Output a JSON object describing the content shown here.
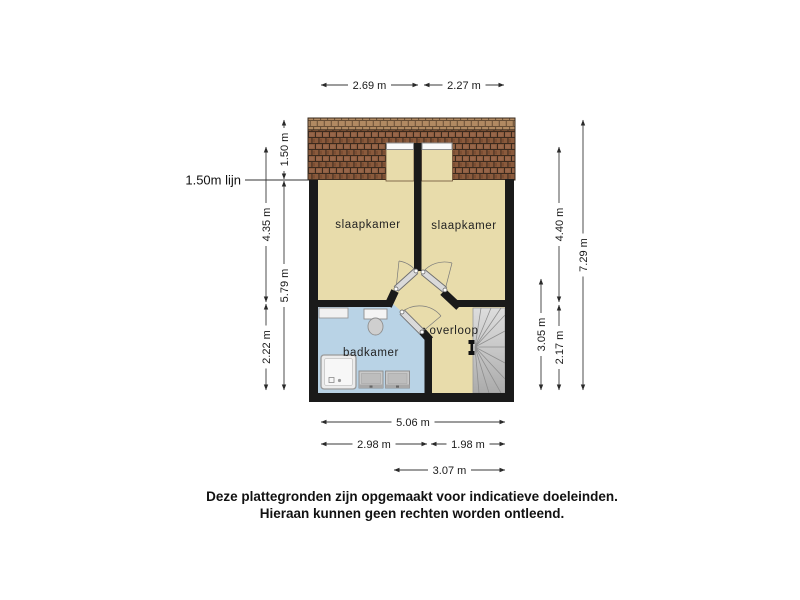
{
  "floorplan": {
    "rooms": {
      "slaapkamer_left": {
        "label": "slaapkamer"
      },
      "slaapkamer_right": {
        "label": "slaapkamer"
      },
      "badkamer": {
        "label": "badkamer"
      },
      "overloop": {
        "label": "overloop"
      }
    },
    "annotations": {
      "height_line_label": "1.50m lijn"
    },
    "dimensions": {
      "top": [
        {
          "label": "2.69 m"
        },
        {
          "label": "2.27 m"
        }
      ],
      "left": [
        {
          "label": "1.50 m"
        },
        {
          "label": "4.35 m"
        },
        {
          "label": "5.79 m"
        },
        {
          "label": "2.22 m"
        }
      ],
      "right": [
        {
          "label": "4.40 m"
        },
        {
          "label": "3.05 m"
        },
        {
          "label": "2.17 m"
        },
        {
          "label": "7.29 m"
        }
      ],
      "bottom": [
        {
          "label": "5.06 m"
        },
        {
          "label": "2.98 m"
        },
        {
          "label": "1.98 m"
        },
        {
          "label": "3.07 m"
        }
      ]
    },
    "fixtures": [
      "roof-tiles",
      "dormer-window",
      "dormer-window",
      "shower",
      "toilet",
      "sink",
      "sink",
      "counter",
      "winder-stairs",
      "stairs-newel"
    ],
    "colors": {
      "floor": "#e8dcab",
      "bathroom_floor": "#b9d3e6",
      "roof_tiles": "#8a5a3c",
      "walls": "#1a1a1a",
      "stairs": "#c6c6c6",
      "background": "#ffffff"
    },
    "disclaimer": {
      "line1": "Deze plattegronden zijn opgemaakt voor indicatieve doeleinden.",
      "line2": "Hieraan kunnen geen rechten worden ontleend."
    }
  }
}
